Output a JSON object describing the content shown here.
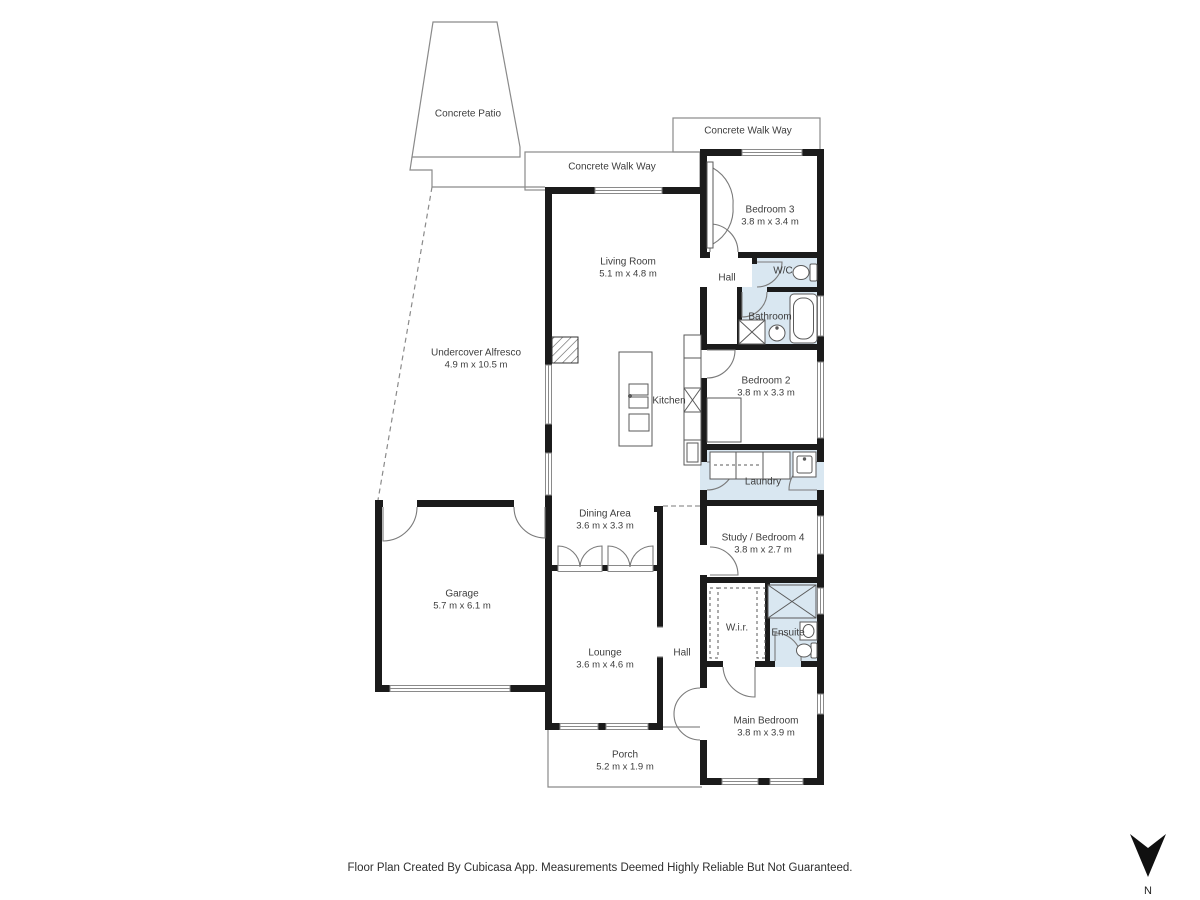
{
  "footer": "Floor Plan Created By Cubicasa App. Measurements Deemed Highly Reliable But Not Guaranteed.",
  "compass_label": "N",
  "colors": {
    "wall": "#1b1b1b",
    "wet_room_fill": "#d9e7f1",
    "thin_line": "#8a8a8a",
    "fixture_line": "#5a5a5a",
    "background": "#ffffff",
    "text": "#3d3d3d"
  },
  "rooms": {
    "concrete_patio": {
      "name": "Concrete Patio"
    },
    "concrete_walk_way_top": {
      "name": "Concrete Walk Way"
    },
    "concrete_walk_way_mid": {
      "name": "Concrete Walk Way"
    },
    "living_room": {
      "name": "Living Room",
      "dims": "5.1 m x 4.8 m"
    },
    "bedroom_3": {
      "name": "Bedroom 3",
      "dims": "3.8 m x 3.4 m"
    },
    "hall_upper": {
      "name": "Hall"
    },
    "wc": {
      "name": "W/C"
    },
    "bathroom": {
      "name": "Bathroom"
    },
    "undercover_alfresco": {
      "name": "Undercover Alfresco",
      "dims": "4.9 m x 10.5 m"
    },
    "kitchen": {
      "name": "Kitchen"
    },
    "bedroom_2": {
      "name": "Bedroom 2",
      "dims": "3.8 m x 3.3 m"
    },
    "laundry": {
      "name": "Laundry"
    },
    "dining_area": {
      "name": "Dining Area",
      "dims": "3.6 m x 3.3 m"
    },
    "garage": {
      "name": "Garage",
      "dims": "5.7 m x 6.1 m"
    },
    "study_bedroom_4": {
      "name": "Study / Bedroom 4",
      "dims": "3.8 m x 2.7 m"
    },
    "wir": {
      "name": "W.i.r."
    },
    "ensuite": {
      "name": "Ensuite"
    },
    "hall_lower": {
      "name": "Hall"
    },
    "lounge": {
      "name": "Lounge",
      "dims": "3.6 m x 4.6 m"
    },
    "main_bedroom": {
      "name": "Main Bedroom",
      "dims": "3.8 m x 3.9 m"
    },
    "porch": {
      "name": "Porch",
      "dims": "5.2 m x 1.9 m"
    }
  }
}
